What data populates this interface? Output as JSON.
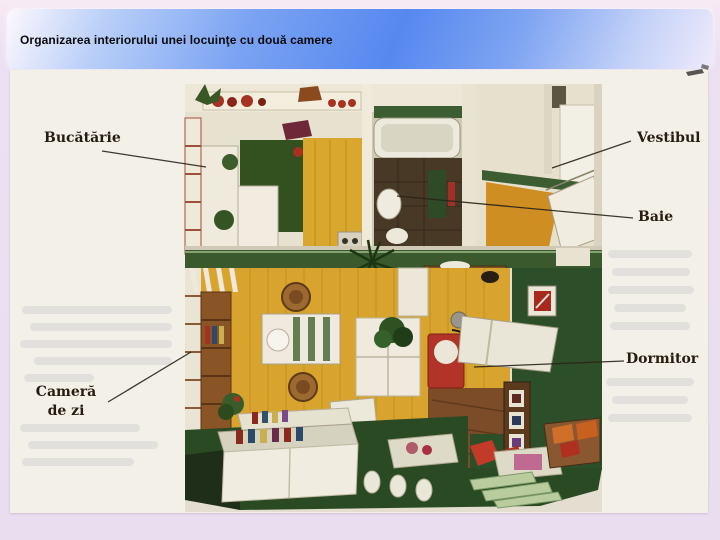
{
  "slide": {
    "title": "Organizarea interiorului unei locuinţe cu două camere"
  },
  "figure": {
    "type": "floor-plan-illustration",
    "description": "Cutaway top-view illustration of a two-room apartment printed on a scanned book page",
    "labels": [
      {
        "id": "bucatarie",
        "text": "Bucătărie"
      },
      {
        "id": "vestibul",
        "text": "Vestibul"
      },
      {
        "id": "baie",
        "text": "Baie"
      },
      {
        "id": "dormitor",
        "text": "Dormitor"
      },
      {
        "id": "camera-de-zi",
        "text": "Cameră de zi",
        "line1": "Cameră",
        "line2": "de zi"
      }
    ]
  },
  "colors": {
    "header_gradient_blue": "#5688ef",
    "slide_background": "#e9def0",
    "paper": "#f3f0e8",
    "floor_ochre": "#d9a42e",
    "carpet_green": "#2c4e28",
    "accent_red": "#b23428",
    "label_text": "#261c10"
  }
}
